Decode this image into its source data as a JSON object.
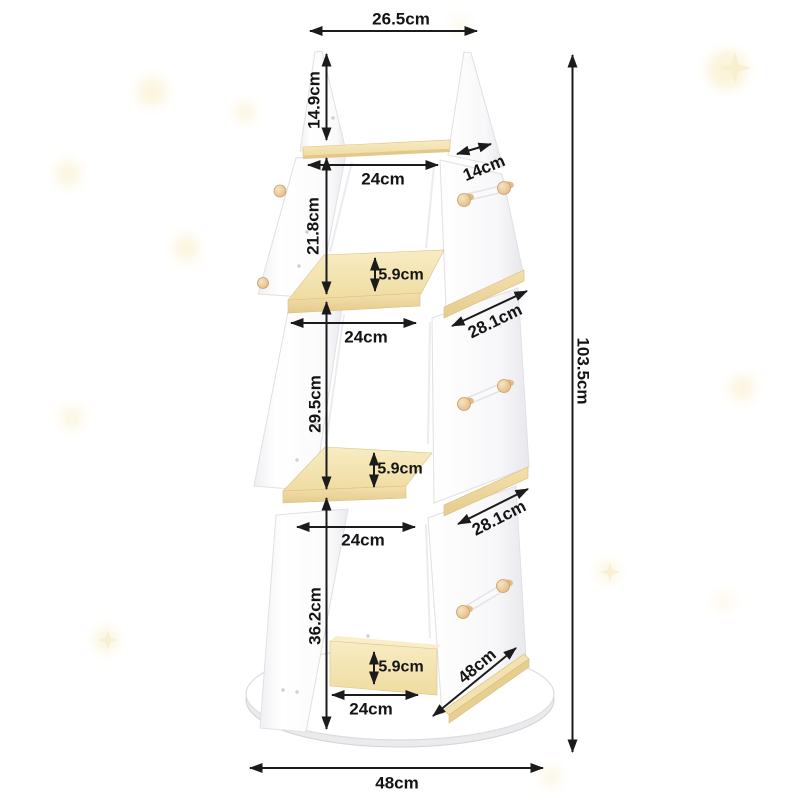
{
  "diagram": {
    "subject": "4-tier tower bookshelf with round rotating base - dimension drawing",
    "unit": "cm",
    "labels": {
      "top_width": "26.5cm",
      "tier1_height": "14.9cm",
      "shelf1_width": "24cm",
      "shelf1_depth": "14cm",
      "tier2_height": "21.8cm",
      "tier2_lip": "5.9cm",
      "shelf2_width": "24cm",
      "shelf2_depth": "28.1cm",
      "tier3_height": "29.5cm",
      "tier3_lip": "5.9cm",
      "shelf3_width": "24cm",
      "shelf3_depth": "28.1cm",
      "tier4_height": "36.2cm",
      "tier4_lip": "5.9cm",
      "shelf4_width": "24cm",
      "base_rail_length": "48cm",
      "total_height": "103.5cm",
      "base_width": "48cm"
    },
    "colors": {
      "dimension_line": "#1b1b1b",
      "panel_white": "#fbfbfc",
      "panel_edge": "#e0e0e5",
      "wood_light": "#f6e9bd",
      "wood_dark": "#e6cd90",
      "peg_wood": "#e8c48d",
      "background_star": "#faf3d6"
    }
  }
}
